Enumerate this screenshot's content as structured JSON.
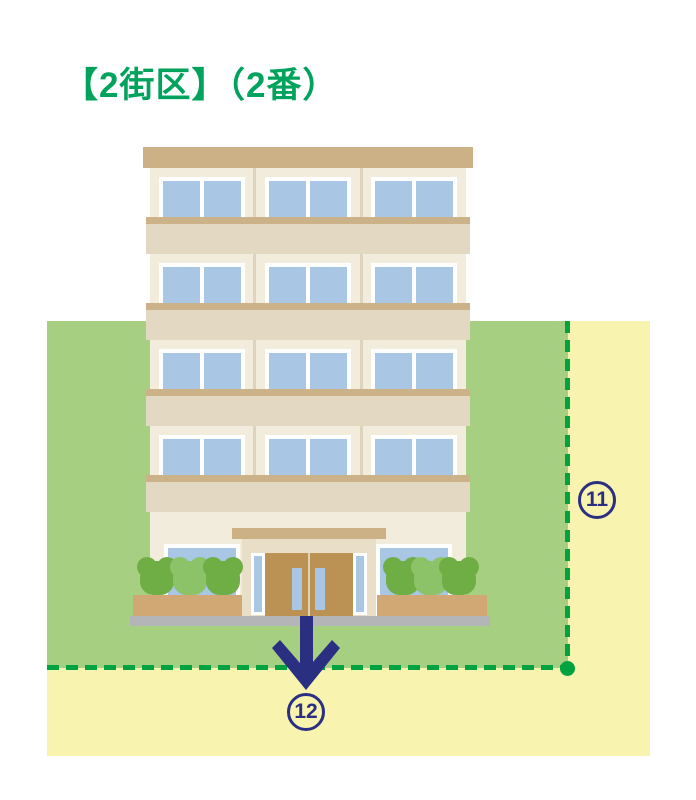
{
  "title": {
    "text": "【2街区】（2番）"
  },
  "labels": {
    "side_boundary": {
      "value": "11",
      "glyph": "⑪"
    },
    "entrance_exit": {
      "value": "12",
      "glyph": "⑫"
    }
  },
  "colors": {
    "title_green": "#00a35c",
    "lot_green": "#a7cf81",
    "surrounding_yellow": "#f8f3ae",
    "boundary_dash_green": "#00a33f",
    "marker_navy": "#2b2f82",
    "building_wall_cream": "#f2ecdc",
    "building_trim_tan": "#cdb186",
    "floor_band_light": "#e3d9c2",
    "floor_band_dark": "#ccb289",
    "window_blue": "#a9c7e5",
    "door_brown": "#bc9254",
    "bush_green_dark": "#6fae45",
    "bush_green_light": "#8cc268",
    "planter_tan": "#d1a873",
    "base_gray": "#b4b5b6"
  }
}
